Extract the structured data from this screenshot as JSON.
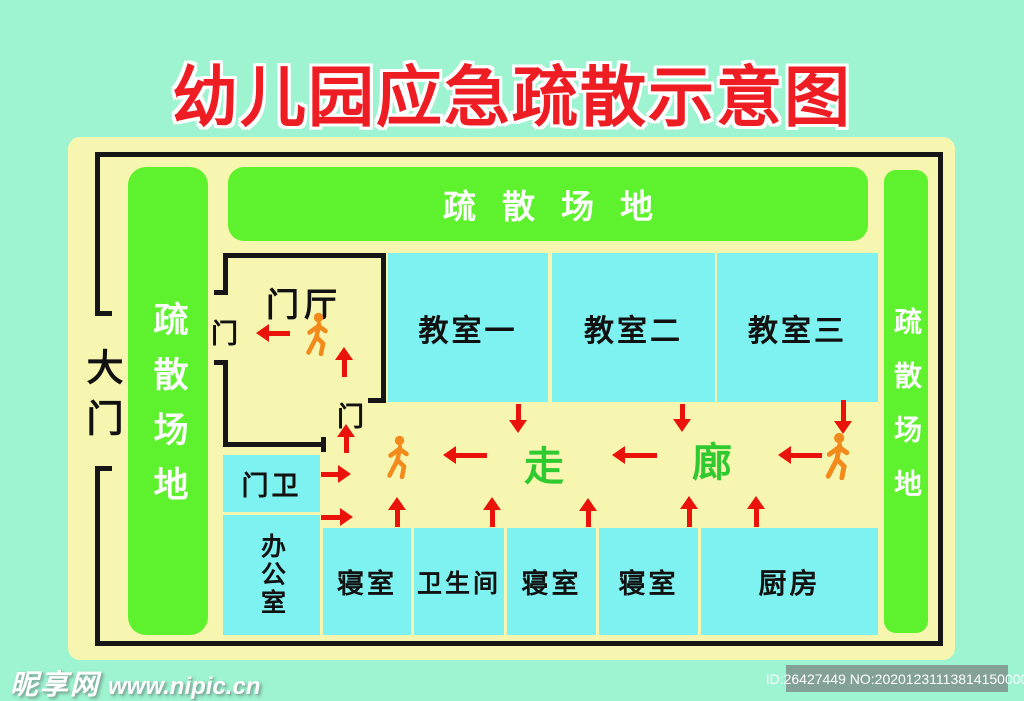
{
  "title": "幼儿园应急疏散示意图",
  "labels": {
    "evac_top": "疏散场地",
    "evac_left": "疏散场地",
    "evac_right": "疏散场地",
    "gate": "大门",
    "door": "门",
    "entrance_hall": "门厅",
    "corridor_left_char": "走",
    "corridor_right_char": "廊"
  },
  "colors": {
    "background_mint": "#9ef3d0",
    "panel_cream": "#f7f6b0",
    "evac_green": "#5ef22e",
    "room_cyan": "#7df2f0",
    "wall_black": "#161616",
    "arrow_red": "#e9130c",
    "person_orange": "#f28b1b",
    "corridor_text_green": "#2fca2f",
    "title_red": "#ee1c23"
  },
  "rooms": [
    {
      "id": "classroom-1",
      "label": "教室一",
      "x": 388,
      "y": 253,
      "w": 160,
      "h": 149,
      "fs": 30
    },
    {
      "id": "classroom-2",
      "label": "教室二",
      "x": 552,
      "y": 253,
      "w": 163,
      "h": 149,
      "fs": 30
    },
    {
      "id": "classroom-3",
      "label": "教室三",
      "x": 717,
      "y": 253,
      "w": 161,
      "h": 149,
      "fs": 30
    },
    {
      "id": "guard-room",
      "label": "门卫",
      "x": 223,
      "y": 455,
      "w": 97,
      "h": 57,
      "fs": 27
    },
    {
      "id": "office",
      "label": "办公室",
      "x": 223,
      "y": 515,
      "w": 97,
      "h": 120,
      "fs": 25,
      "vertical": true
    },
    {
      "id": "dorm-1",
      "label": "寝室",
      "x": 323,
      "y": 528,
      "w": 88,
      "h": 107,
      "fs": 27
    },
    {
      "id": "bathroom",
      "label": "卫生间",
      "x": 414,
      "y": 528,
      "w": 90,
      "h": 107,
      "fs": 25
    },
    {
      "id": "dorm-2",
      "label": "寝室",
      "x": 507,
      "y": 528,
      "w": 89,
      "h": 107,
      "fs": 27
    },
    {
      "id": "dorm-3",
      "label": "寝室",
      "x": 599,
      "y": 528,
      "w": 99,
      "h": 107,
      "fs": 27
    },
    {
      "id": "kitchen",
      "label": "厨房",
      "x": 701,
      "y": 528,
      "w": 177,
      "h": 107,
      "fs": 28
    }
  ],
  "doors": [
    {
      "x": 211,
      "y": 312
    },
    {
      "x": 337,
      "y": 395
    }
  ],
  "arrows": [
    {
      "dir": "left",
      "x": 256,
      "y": 324,
      "len": 34
    },
    {
      "dir": "up",
      "x": 335,
      "y": 347,
      "len": 30
    },
    {
      "dir": "up",
      "x": 337,
      "y": 424,
      "len": 29
    },
    {
      "dir": "down",
      "x": 509,
      "y": 404,
      "len": 29
    },
    {
      "dir": "down",
      "x": 673,
      "y": 404,
      "len": 28
    },
    {
      "dir": "down",
      "x": 834,
      "y": 400,
      "len": 34
    },
    {
      "dir": "left",
      "x": 443,
      "y": 446,
      "len": 44
    },
    {
      "dir": "left",
      "x": 612,
      "y": 446,
      "len": 45
    },
    {
      "dir": "left",
      "x": 778,
      "y": 446,
      "len": 44
    },
    {
      "dir": "up",
      "x": 388,
      "y": 497,
      "len": 30
    },
    {
      "dir": "up",
      "x": 483,
      "y": 497,
      "len": 30
    },
    {
      "dir": "up",
      "x": 579,
      "y": 498,
      "len": 29
    },
    {
      "dir": "up",
      "x": 680,
      "y": 496,
      "len": 31
    },
    {
      "dir": "up",
      "x": 747,
      "y": 496,
      "len": 31
    },
    {
      "dir": "right",
      "x": 321,
      "y": 465,
      "len": 30
    },
    {
      "dir": "right",
      "x": 321,
      "y": 508,
      "len": 32
    }
  ],
  "persons": [
    {
      "x": 302,
      "y": 312,
      "s": 1.0
    },
    {
      "x": 383,
      "y": 435,
      "s": 1.0
    },
    {
      "x": 821,
      "y": 432,
      "s": 1.1
    }
  ],
  "watermark": {
    "site_name": "昵享网",
    "site_url": "www.nipic.cn"
  },
  "id_badge": "ID:26427449 NO:20201231113814150000"
}
